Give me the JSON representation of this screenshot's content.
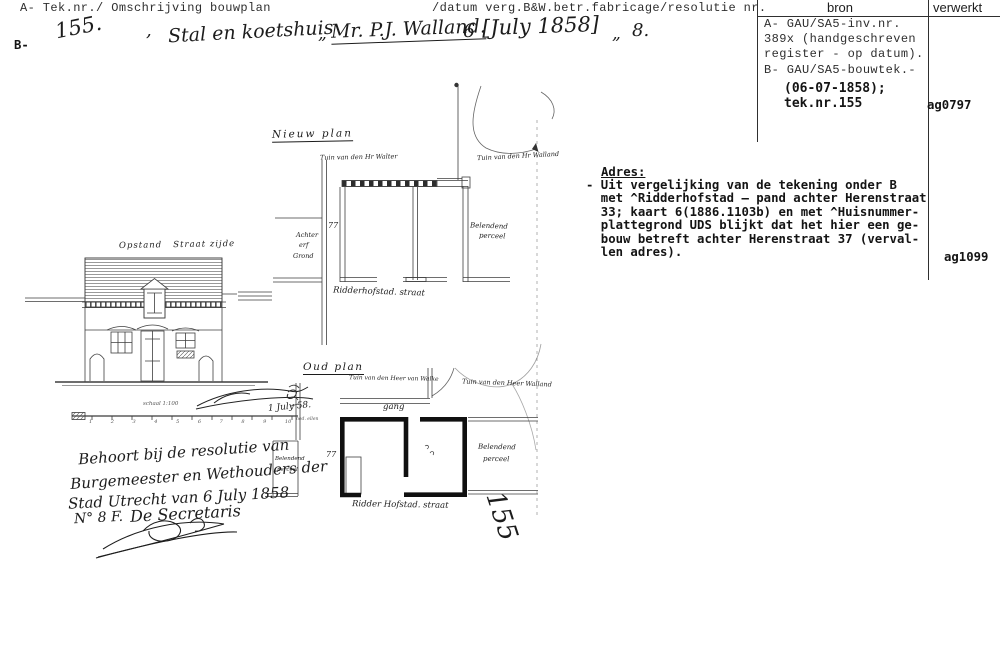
{
  "header": {
    "left_title": "A- Tek.nr./ Omschrijving bouwplan",
    "right_title": "/datum verg.B&W.betr.fabricage/resolutie nr.",
    "col_bron": "bron",
    "col_verwerkt": "verwerkt",
    "row_b_label": "B-"
  },
  "entry": {
    "tek_nr": "155.",
    "comma": ",",
    "omschrijving": "Stal en koetshuis",
    "quote1": "„",
    "aanvrager": "Mr. P.J. Walland.",
    "datum_day": "6",
    "datum": "[July 1858]",
    "quote2": "„",
    "resolutie_nr": "8."
  },
  "bron": {
    "lines_typed": [
      "A- GAU/SA5-inv.nr.",
      "389x (handgeschreven",
      "register - op datum).",
      "B- GAU/SA5-bouwtek.-"
    ],
    "lines_added": [
      "(06-07-1858);",
      "tek.nr.155"
    ]
  },
  "verwerkt": {
    "code_a": "ag0797",
    "code_b": "ag1099"
  },
  "adres": {
    "heading": "Adres:",
    "lines": [
      "- Uit vergelijking van de tekening onder B",
      "  met ^Ridderhofstad – pand achter Herenstraat",
      "  33; kaart 6(1886.1103b) en met ^Huisnummer-",
      "  plattegrond UDS blijkt dat het hier een ge-",
      "  bouw betreft achter Herenstraat 37 (verval-",
      "  len adres)."
    ]
  },
  "drawing": {
    "elevation_title": "Opstand   Straat zijde",
    "scale_label": "schaal 1:100",
    "scale_numbers": "1 2 3 4 5 6 7 8 9 10",
    "scale_end": "ned. ellen",
    "sign_date": "1 July 58.",
    "stamp_number": "155",
    "nieuw": {
      "title": "Nieuw plan",
      "garden_left": "Tuin van den Hr Walter",
      "garden_right": "Tuin van den Hr Walland",
      "street": "Ridderhofstad. straat",
      "plot_left": [
        "Achter",
        "erf",
        "Grond"
      ],
      "plot_right": [
        "Belendend",
        "perceel"
      ],
      "door_mark": "77"
    },
    "oud": {
      "title": "Oud plan",
      "garden_left": "Tuin van den Heer van Walke",
      "garden_right": "Tuin van den Heer Walland",
      "gang": "gang",
      "street": "Ridder Hofstad. straat",
      "plot_left": [
        "Belendend",
        "perceel"
      ],
      "plot_right": [
        "Belendend",
        "perceel"
      ],
      "door_mark": "77"
    },
    "approval": {
      "lines": [
        "Behoort bij de resolutie van",
        "Burgemeester en Wethouders der",
        "Stad Utrecht van 6 July 1858",
        "N° 8 F."
      ],
      "secretaris": "De Secretaris"
    }
  },
  "colors": {
    "ink": "#1a1a1a",
    "ink_light": "#3f3f3f",
    "paper": "#ffffff"
  }
}
